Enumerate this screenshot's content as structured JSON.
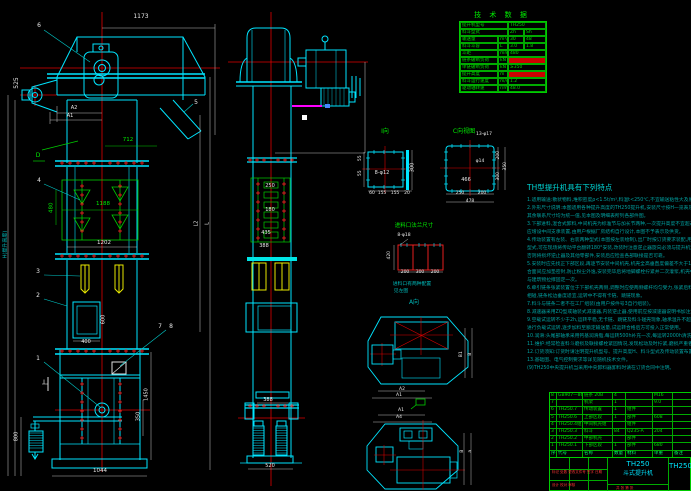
{
  "accent_colors": {
    "outline_cyan": "#00ffff",
    "centerline_red": "#ff0000",
    "table_green": "#00dd00",
    "bucket_yellow": "#ffff00",
    "highlight_magenta": "#ff00ff",
    "notes_teal": "#00a0a0",
    "dim_white": "#e8e8e8"
  },
  "tech_table": {
    "title": "技 术 数 据",
    "rows": [
      [
        {
          "t": "提升机型号",
          "w": 48
        },
        {
          "t": "TH250",
          "w": 38
        }
      ],
      [
        {
          "t": "料斗型式",
          "w": 48
        },
        {
          "t": "Zh",
          "w": 16
        },
        {
          "t": "Sh",
          "w": 22
        }
      ],
      [
        {
          "t": "输送量",
          "w": 38
        },
        {
          "t": "m³/h",
          "w": 10
        },
        {
          "t": "30",
          "w": 16
        },
        {
          "t": "48",
          "w": 22
        }
      ],
      [
        {
          "t": "料斗斗容",
          "w": 38
        },
        {
          "t": "L",
          "w": 10
        },
        {
          "t": "3.0",
          "w": 16
        },
        {
          "t": "1.8",
          "w": 22
        }
      ],
      [
        {
          "t": "斗距",
          "w": 38
        },
        {
          "t": "mm",
          "w": 10
        },
        {
          "t": "480",
          "w": 38
        }
      ],
      [
        {
          "t": "链条破断负荷",
          "w": 38
        },
        {
          "t": "kN",
          "w": 10
        },
        {
          "t": "",
          "w": 38,
          "red": true
        }
      ],
      [
        {
          "t": "单链破断负荷",
          "w": 38
        },
        {
          "t": "kN",
          "w": 10
        },
        {
          "t": "≥350",
          "w": 38
        }
      ],
      [
        {
          "t": "提升高度",
          "w": 38
        },
        {
          "t": "m",
          "w": 10
        },
        {
          "t": "",
          "w": 38,
          "red": true
        }
      ],
      [
        {
          "t": "料斗运行速度",
          "w": 38
        },
        {
          "t": "m/s",
          "w": 10
        },
        {
          "t": "1.2",
          "w": 38
        }
      ],
      [
        {
          "t": "驱动轴转速",
          "w": 38
        },
        {
          "t": "r/min",
          "w": 10
        },
        {
          "t": "48.0",
          "w": 38
        }
      ]
    ]
  },
  "notes": {
    "heading": "TH型提升机具有下列特点",
    "lines": [
      "1.适用输送:散状物料,堆积密度ρ<1.5t/m³,料温t<250℃,不宜输送粘性大及易结块物料。",
      "2.外形尺寸说明:本图适用各种提升高度的TH250提升机,安装尺寸按H一览表及订货合同为准,",
      "  其余联系尺寸均为统一值,见本图及明细表所列各部件图。",
      "3.下部进料,混合式卸料,中间机壳为标准节与加长节两种,一次提升高度不宜超过40m,过高时",
      "  应增设中间支承装置,由用户根据厂房结构自行设计,本图不予表示及供货。",
      "4.传动装置有左装、右装两种型式(本图按左装绘制),出厂时按订货要求装配,用户如需改变装配",
      "  型式,可在现场将传动平台翻转180°安装,改装时注意逆止器旋向必须与提升机运转方向一致,",
      "  否则将损坏逆止器及其他零部件,安装后应检查各部联接是否可靠。",
      "5.安装时应先找正下部区段,再逐节安装中间机壳,机壳全高垂直度偏差不大于10mm,各法兰结",
      "  合面间应加垫密封,防止粉尘外逸,安装完毕后将地脚螺栓拧紧并二次灌浆,机壳中部每隔3m",
      "  与建筑物拉撑固定一次。",
      "6.牵引链条张紧装置位于下部机壳两侧,调整时应使两侧螺杆均匀受力,张紧后料斗不得与机壳",
      "  相碰,链条松边垂度适宜,运转中不得有卡链、跳链现象。",
      "7.料斗与链条二者不在工厂组装(由用户按件号3自行组装)。",
      "8.减速器采用ZQ型或轴装式减速器,内装逆止器,使用前应按减速器说明书加注润滑油。",
      "9.空载试运转不少于2h,运转平稳,无卡链、跳链及料斗碰壳现象,轴承温升不超过25℃,方可",
      "  进行负载试运转,逐步加料至额定输送量,试运转合格后方可投入正常使用。",
      "10.润滑:头尾部轴承采用钙基润滑脂,每运转500h补充一次,每运转2000h清洗更换。",
      "11.维护:经常检查料斗磨损及联接螺栓紧固情况,发现松动及时拧紧,磨损严重者应及时更换。",
      "12.订货须知:订货时请注明提升机型号、提升高度H、料斗型式及传动装置布置型式。",
      "13.基础图、电气控制要求等详见随机技术文件。",
      "(9)TH250中央提升机当采用中央卸料器卸料时请在订货合同中注明。"
    ]
  },
  "bom": {
    "col_widths": [
      7,
      26,
      30,
      13,
      27,
      20,
      19
    ],
    "rows": [
      [
        "8",
        "GB907—86",
        "链条 20B",
        "4",
        "",
        "M16",
        ""
      ],
      [
        "7",
        "",
        "机架",
        "1",
        "",
        "9.0",
        ""
      ],
      [
        "6",
        "TH250.7",
        "传动装置",
        "1",
        "组件",
        "",
        ""
      ],
      [
        "5",
        "TH250.6",
        "上部区段",
        "1",
        "部件",
        "608",
        ""
      ],
      [
        "4",
        "TH250.4组",
        "中间机壳组",
        "",
        "组件",
        "",
        ""
      ],
      [
        "3",
        "TH250.3",
        "料斗",
        "84",
        "Q235-A",
        "204",
        ""
      ],
      [
        "2",
        "TH250.2",
        "中部机壳",
        "",
        "部件",
        "",
        ""
      ],
      [
        "1",
        "TH250.1",
        "下部区段",
        "1",
        "部件",
        "680",
        ""
      ]
    ],
    "header": [
      "序号",
      "代号",
      "名称",
      "数量",
      "材料",
      "单重",
      "备注"
    ]
  },
  "title_block": {
    "model": "TH250",
    "name": "斗式提升机",
    "right_model": "TH250",
    "rev_line": "标记 处数 更改文件号 签字 日期",
    "sign_line": "设计  校对  审核",
    "sheet_line": "共 张 第 张"
  },
  "annotations": [
    {
      "t": "1173",
      "x": 141,
      "y": 14,
      "c": "w"
    },
    {
      "t": "6",
      "x": 39,
      "y": 23,
      "c": "w",
      "n": "balloon-6"
    },
    {
      "t": "525",
      "x": 17,
      "y": 80,
      "c": "w",
      "r": -90
    },
    {
      "t": "A2",
      "x": 74,
      "y": 106,
      "c": "w",
      "s": 5
    },
    {
      "t": "A1",
      "x": 70,
      "y": 114,
      "c": "w",
      "s": 5
    },
    {
      "t": "5",
      "x": 196,
      "y": 100,
      "c": "w",
      "n": "balloon-5"
    },
    {
      "t": "D",
      "x": 38,
      "y": 153,
      "c": "g",
      "n": "balloon-D"
    },
    {
      "t": "712",
      "x": 128,
      "y": 138,
      "c": "g",
      "s": 5.5
    },
    {
      "t": "4",
      "x": 39,
      "y": 178,
      "c": "w",
      "n": "balloon-4"
    },
    {
      "t": "480",
      "x": 52,
      "y": 205,
      "c": "g",
      "r": -90,
      "s": 5.5
    },
    {
      "t": "1188",
      "x": 103,
      "y": 202,
      "c": "g",
      "s": 5.5
    },
    {
      "t": "1202",
      "x": 104,
      "y": 241,
      "c": "w",
      "s": 5.5
    },
    {
      "t": "3",
      "x": 38,
      "y": 269,
      "c": "w",
      "n": "balloon-3"
    },
    {
      "t": "2",
      "x": 38,
      "y": 293,
      "c": "w",
      "n": "balloon-2"
    },
    {
      "t": "600",
      "x": 104,
      "y": 317,
      "c": "w",
      "r": -90,
      "s": 5
    },
    {
      "t": "7",
      "x": 160,
      "y": 324,
      "c": "w",
      "n": "balloon-7"
    },
    {
      "t": "8",
      "x": 171,
      "y": 324,
      "c": "w",
      "n": "balloon-8"
    },
    {
      "t": "400",
      "x": 86,
      "y": 340,
      "c": "w",
      "s": 5
    },
    {
      "t": "1",
      "x": 38,
      "y": 356,
      "c": "w",
      "n": "balloon-1"
    },
    {
      "t": "I",
      "x": 44,
      "y": 380,
      "c": "w"
    },
    {
      "t": "1450",
      "x": 147,
      "y": 392,
      "c": "w",
      "r": -90,
      "s": 5
    },
    {
      "t": "350",
      "x": 139,
      "y": 414,
      "c": "w",
      "r": -90,
      "s": 5
    },
    {
      "t": "800",
      "x": 17,
      "y": 434,
      "c": "w",
      "r": -90,
      "s": 5
    },
    {
      "t": "1044",
      "x": 100,
      "y": 469,
      "c": "w",
      "s": 5.5
    },
    {
      "t": "H(提升高度)",
      "x": 6,
      "y": 242,
      "c": "cy",
      "r": -90,
      "s": 5
    },
    {
      "t": "L2",
      "x": 197,
      "y": 221,
      "c": "w",
      "r": -90,
      "s": 5
    },
    {
      "t": "L",
      "x": 208,
      "y": 221,
      "c": "w",
      "r": -90,
      "s": 5
    },
    {
      "t": "250",
      "x": 270,
      "y": 184,
      "c": "w",
      "s": 5
    },
    {
      "t": "180",
      "x": 270,
      "y": 208,
      "c": "w",
      "s": 5
    },
    {
      "t": "435",
      "x": 266,
      "y": 231,
      "c": "w",
      "s": 5
    },
    {
      "t": "388",
      "x": 264,
      "y": 244,
      "c": "w",
      "s": 5
    },
    {
      "t": "388",
      "x": 268,
      "y": 398,
      "c": "w",
      "s": 5
    },
    {
      "t": "520",
      "x": 270,
      "y": 464,
      "c": "w",
      "s": 5
    },
    {
      "t": "I向",
      "x": 385,
      "y": 129,
      "c": "g",
      "s": 6,
      "n": "view-label-I"
    },
    {
      "t": "8-φ12",
      "x": 382,
      "y": 171,
      "c": "w",
      "s": 5
    },
    {
      "t": "300",
      "x": 413,
      "y": 165,
      "c": "w",
      "r": -90,
      "s": 5
    },
    {
      "t": "55",
      "x": 361,
      "y": 156,
      "c": "w",
      "r": -90,
      "s": 4.5
    },
    {
      "t": "55",
      "x": 361,
      "y": 171,
      "c": "w",
      "r": -90,
      "s": 4.5
    },
    {
      "t": "60",
      "x": 372,
      "y": 192,
      "c": "w",
      "s": 4.5
    },
    {
      "t": "155",
      "x": 382,
      "y": 192,
      "c": "w",
      "s": 4.5
    },
    {
      "t": "155",
      "x": 395,
      "y": 192,
      "c": "w",
      "s": 4.5
    },
    {
      "t": "20",
      "x": 407,
      "y": 192,
      "c": "w",
      "s": 4.5
    },
    {
      "t": "C向视图",
      "x": 464,
      "y": 129,
      "c": "g",
      "s": 6,
      "n": "view-label-C"
    },
    {
      "t": "13-φ17",
      "x": 484,
      "y": 133,
      "c": "w",
      "s": 4.5
    },
    {
      "t": "466",
      "x": 466,
      "y": 178,
      "c": "w",
      "s": 5
    },
    {
      "t": "φ14",
      "x": 480,
      "y": 160,
      "c": "w",
      "s": 4.5
    },
    {
      "t": "200",
      "x": 499,
      "y": 153,
      "c": "w",
      "r": -90,
      "s": 4.5
    },
    {
      "t": "300",
      "x": 499,
      "y": 174,
      "c": "w",
      "r": -90,
      "s": 4.5
    },
    {
      "t": "350",
      "x": 506,
      "y": 164,
      "c": "w",
      "r": -90,
      "s": 4.5
    },
    {
      "t": "250",
      "x": 460,
      "y": 192,
      "c": "w",
      "s": 4.5
    },
    {
      "t": "200",
      "x": 482,
      "y": 192,
      "c": "w",
      "s": 4.5
    },
    {
      "t": "478",
      "x": 470,
      "y": 200,
      "c": "w",
      "s": 4.5
    },
    {
      "t": "进料口法兰尺寸",
      "x": 414,
      "y": 224,
      "c": "g",
      "s": 5.5,
      "n": "detail-title-inlet"
    },
    {
      "t": "8-φ18",
      "x": 404,
      "y": 234,
      "c": "w",
      "s": 4.5
    },
    {
      "t": "420",
      "x": 390,
      "y": 253,
      "c": "w",
      "r": -90,
      "s": 4.5
    },
    {
      "t": "200",
      "x": 405,
      "y": 271,
      "c": "w",
      "s": 4.5
    },
    {
      "t": "300",
      "x": 420,
      "y": 271,
      "c": "w",
      "s": 4.5
    },
    {
      "t": "200",
      "x": 435,
      "y": 271,
      "c": "w",
      "s": 4.5
    },
    {
      "t": "进料口有两种配置",
      "x": 412,
      "y": 283,
      "c": "cy",
      "s": 4.8
    },
    {
      "t": "见左图",
      "x": 401,
      "y": 290,
      "c": "cy",
      "s": 4.8
    },
    {
      "t": "A向",
      "x": 414,
      "y": 300,
      "c": "cy",
      "s": 6,
      "n": "view-label-A"
    },
    {
      "t": "B1",
      "x": 462,
      "y": 352,
      "c": "w",
      "r": -90,
      "s": 4.5
    },
    {
      "t": "B",
      "x": 471,
      "y": 352,
      "c": "w",
      "r": -90,
      "s": 4.5
    },
    {
      "t": "A2",
      "x": 402,
      "y": 388,
      "c": "w",
      "s": 4.5
    },
    {
      "t": "A1",
      "x": 399,
      "y": 394,
      "c": "w",
      "s": 4.5
    },
    {
      "t": "A1",
      "x": 401,
      "y": 409,
      "c": "w",
      "s": 4.5
    },
    {
      "t": "A4",
      "x": 399,
      "y": 416,
      "c": "w",
      "s": 4.5
    },
    {
      "t": "B",
      "x": 463,
      "y": 449,
      "c": "w",
      "r": -90,
      "s": 4.5
    },
    {
      "t": "a",
      "x": 471,
      "y": 449,
      "c": "w",
      "r": -90,
      "s": 4.5
    }
  ]
}
